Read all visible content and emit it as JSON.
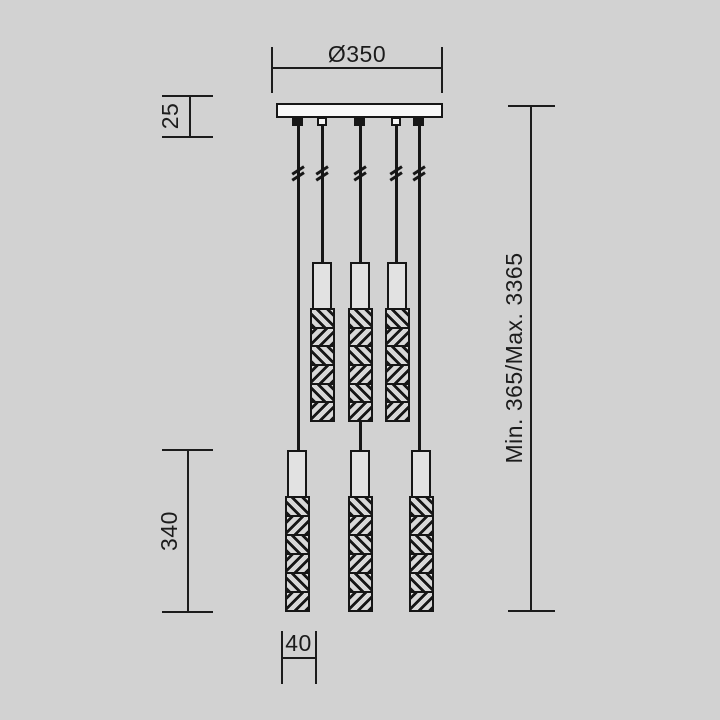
{
  "colors": {
    "background": "#d2d2d2",
    "line": "#1c1c1c",
    "canopy_fill": "#f8f8f8",
    "tube_fill": "#e2e2e2"
  },
  "drawing": {
    "kind": "pendant-light dimension drawing",
    "labels": {
      "canopy_diameter": "Ø350",
      "canopy_height": "25",
      "shade_length": "340",
      "shade_width": "40",
      "suspension_height": "Min. 365/Max. 3365"
    }
  }
}
